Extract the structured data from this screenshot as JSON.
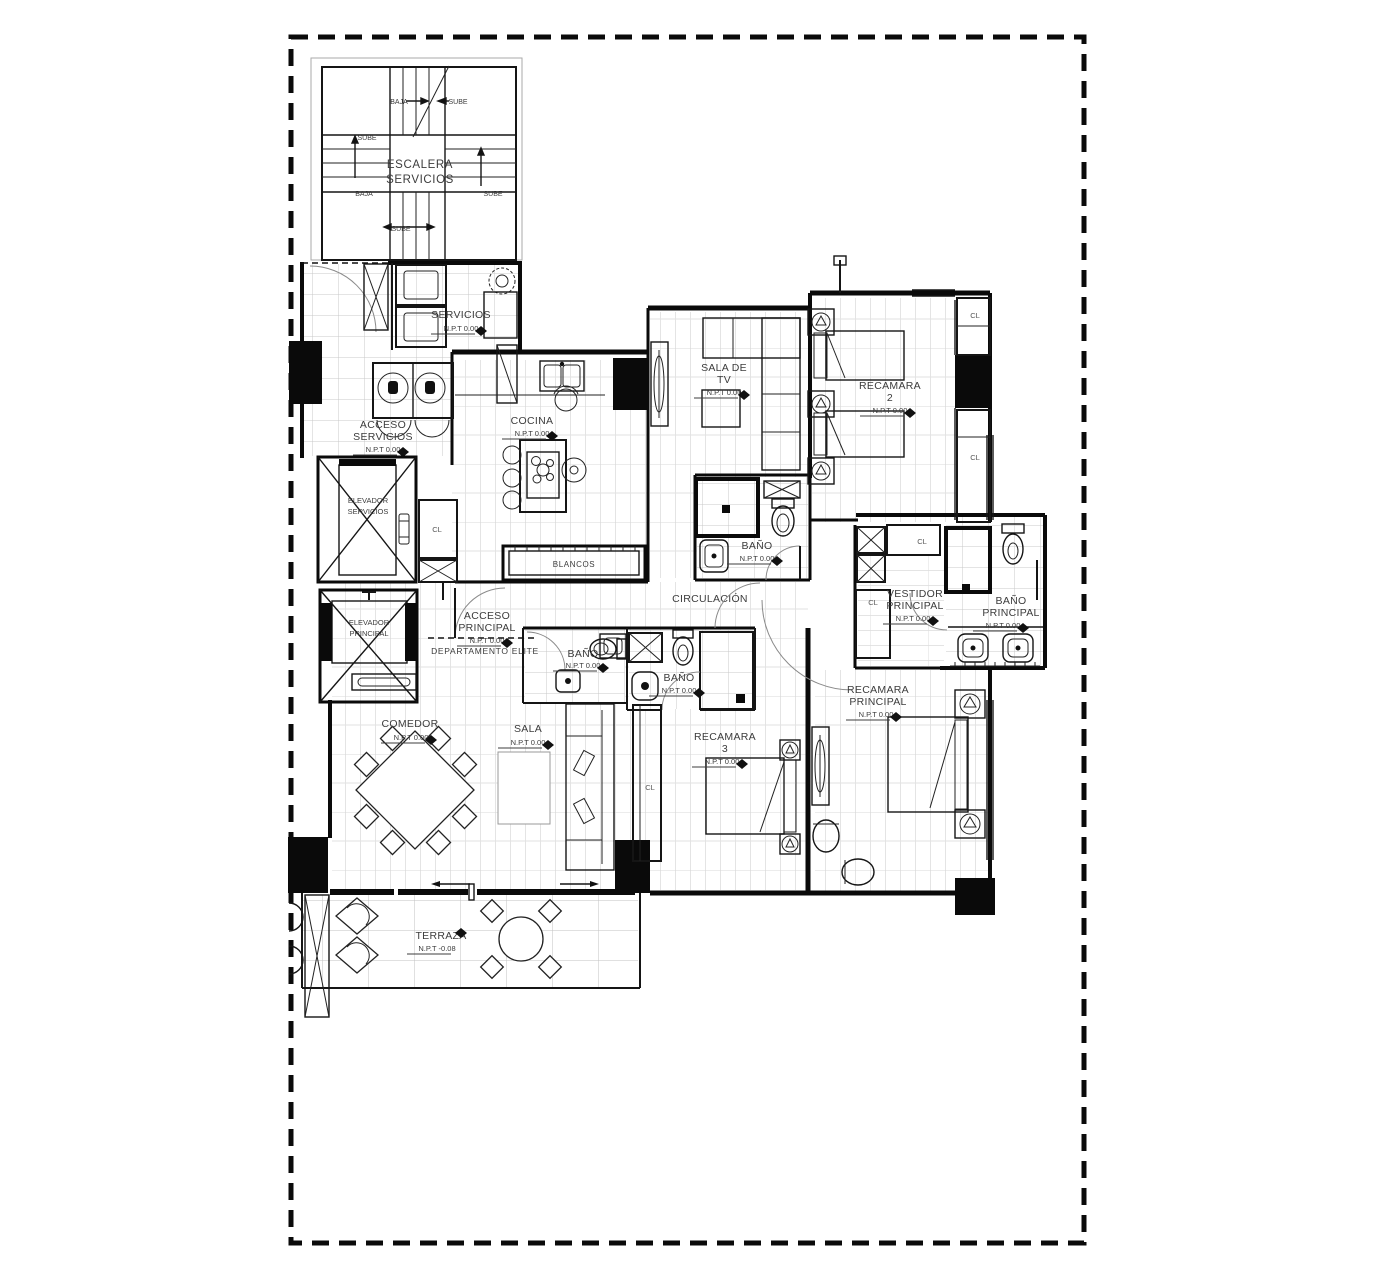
{
  "plan": {
    "stairs": {
      "name1": "ESCALERA",
      "name2": "SERVICIOS",
      "sube": "SUBE",
      "baja": "BAJA"
    },
    "closet_label": "CL",
    "rooms": {
      "servicios": {
        "name": "SERVICIOS",
        "level": "N.P.T 0.00"
      },
      "acceso_servicios": {
        "line1": "ACCESO",
        "line2": "SERVICIOS",
        "level": "N.P.T 0.00"
      },
      "cocina": {
        "name": "COCINA",
        "level": "N.P.T 0.00"
      },
      "sala_de_tv": {
        "line1": "SALA DE",
        "line2": "TV",
        "level": "N.P.T 0.00"
      },
      "recamara_2": {
        "line1": "RECAMARA",
        "line2": "2",
        "level": "N.P.T 0.00"
      },
      "bano_central": {
        "name": "BAÑO",
        "level": "N.P.T 0.00"
      },
      "circulacion": {
        "name": "CIRCULACIÓN"
      },
      "elevador_servicios": {
        "line1": "ELEVADOR",
        "line2": "SERVICIOS"
      },
      "elevador_principal": {
        "line1": "ELEVADOR",
        "line2": "PRINCIPAL"
      },
      "acceso_principal": {
        "line1": "ACCESO",
        "line2": "PRINCIPAL",
        "level": "N.P.T 0.00"
      },
      "departamento_elite": {
        "name": "DEPARTAMENTO ELITE"
      },
      "bano_entrada": {
        "name": "BAÑO",
        "level": "N.P.T 0.00"
      },
      "bano_recamara3": {
        "name": "BAÑO",
        "level": "N.P.T 0.00"
      },
      "vestidor_principal": {
        "line1": "VESTIDOR",
        "line2": "PRINCIPAL",
        "level": "N.P.T 0.00"
      },
      "bano_principal": {
        "line1": "BAÑO",
        "line2": "PRINCIPAL",
        "level": "N.P.T 0.00"
      },
      "recamara_principal": {
        "line1": "RECAMARA",
        "line2": "PRINCIPAL",
        "level": "N.P.T 0.00"
      },
      "recamara_3": {
        "line1": "RECAMARA",
        "line2": "3",
        "level": "N.P.T 0.00"
      },
      "comedor": {
        "name": "COMEDOR",
        "level": "N.P.T 0.00"
      },
      "sala": {
        "name": "SALA",
        "level": "N.P.T 0.00"
      },
      "blancos": {
        "name": "BLANCOS"
      },
      "terraza": {
        "name": "TERRAZA",
        "level": "N.P.T -0.08"
      }
    }
  }
}
